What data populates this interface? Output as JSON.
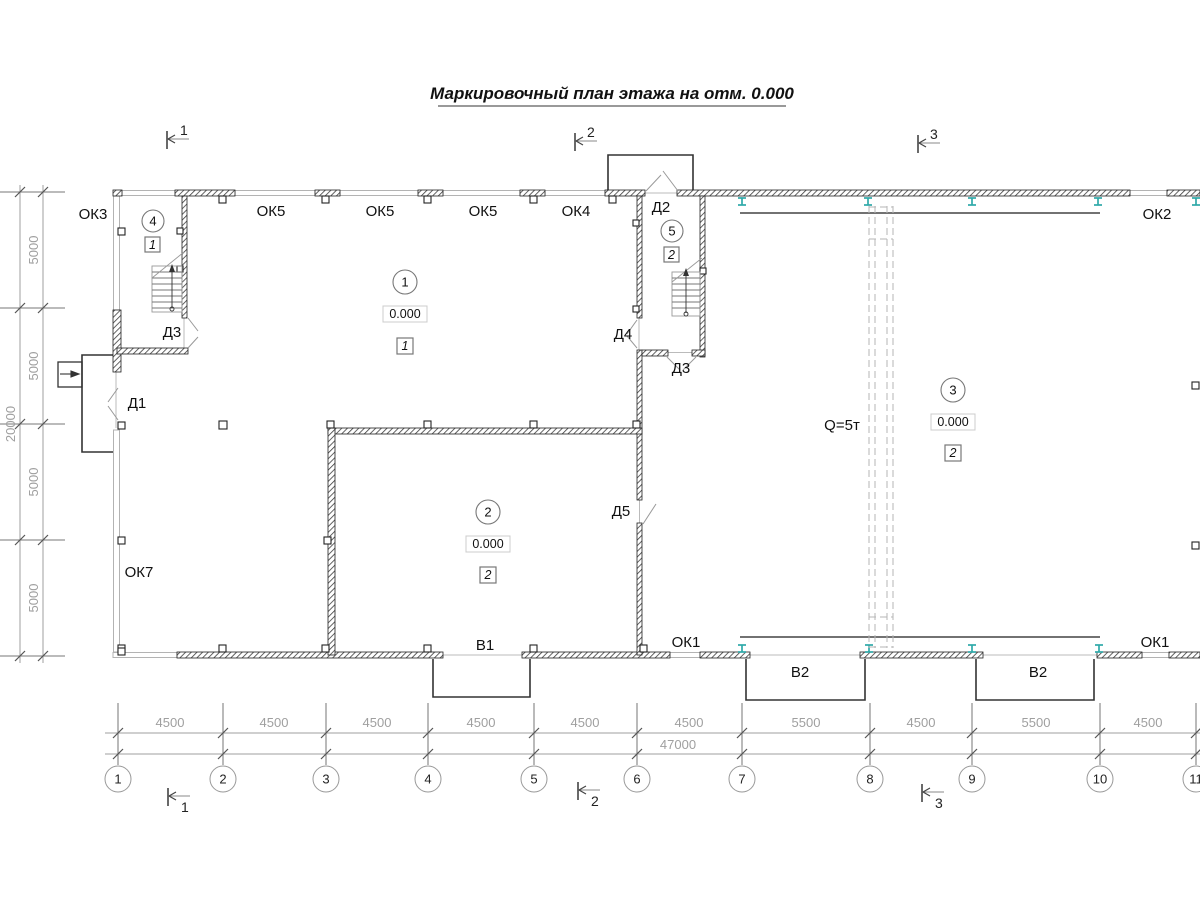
{
  "title": {
    "text": "Маркировочный план этажа на отм. 0.000"
  },
  "section_marks": {
    "top": [
      "1",
      "2",
      "3"
    ],
    "bottom": [
      "1",
      "2",
      "3"
    ]
  },
  "wall_labels": {
    "ok3": "ОК3",
    "ok5_1": "ОК5",
    "ok5_2": "ОК5",
    "ok5_3": "ОК5",
    "ok4": "ОК4",
    "ok2": "ОК2",
    "ok7": "ОК7",
    "ok1_1": "ОК1",
    "ok1_2": "ОК1",
    "d1": "Д1",
    "d2": "Д2",
    "d3_1": "Д3",
    "d3_2": "Д3",
    "d4": "Д4",
    "d5": "Д5",
    "v1": "В1",
    "v2_1": "В2",
    "v2_2": "В2"
  },
  "rooms": {
    "r1": {
      "num": "1",
      "elevation": "0.000",
      "floor_type": "1"
    },
    "r2": {
      "num": "2",
      "elevation": "0.000",
      "floor_type": "2"
    },
    "r3": {
      "num": "3",
      "elevation": "0.000",
      "floor_type": "2"
    },
    "r4": {
      "num": "4",
      "floor_type": "1"
    },
    "r5": {
      "num": "5",
      "floor_type": "2"
    }
  },
  "crane": {
    "capacity": "Q=5т"
  },
  "grid": {
    "columns": [
      "1",
      "2",
      "3",
      "4",
      "5",
      "6",
      "7",
      "8",
      "9",
      "10",
      "11"
    ]
  },
  "dimensions": {
    "bottom_segments": [
      "4500",
      "4500",
      "4500",
      "4500",
      "4500",
      "4500",
      "5500",
      "4500",
      "5500",
      "4500"
    ],
    "bottom_total": "47000",
    "left_segments": [
      "5000",
      "5000",
      "5000",
      "5000"
    ],
    "left_total": "20000"
  },
  "colors": {
    "steel_column": "#2fa9a9",
    "wall_hatch": "#444444",
    "dim_line": "#9f9f9f"
  }
}
